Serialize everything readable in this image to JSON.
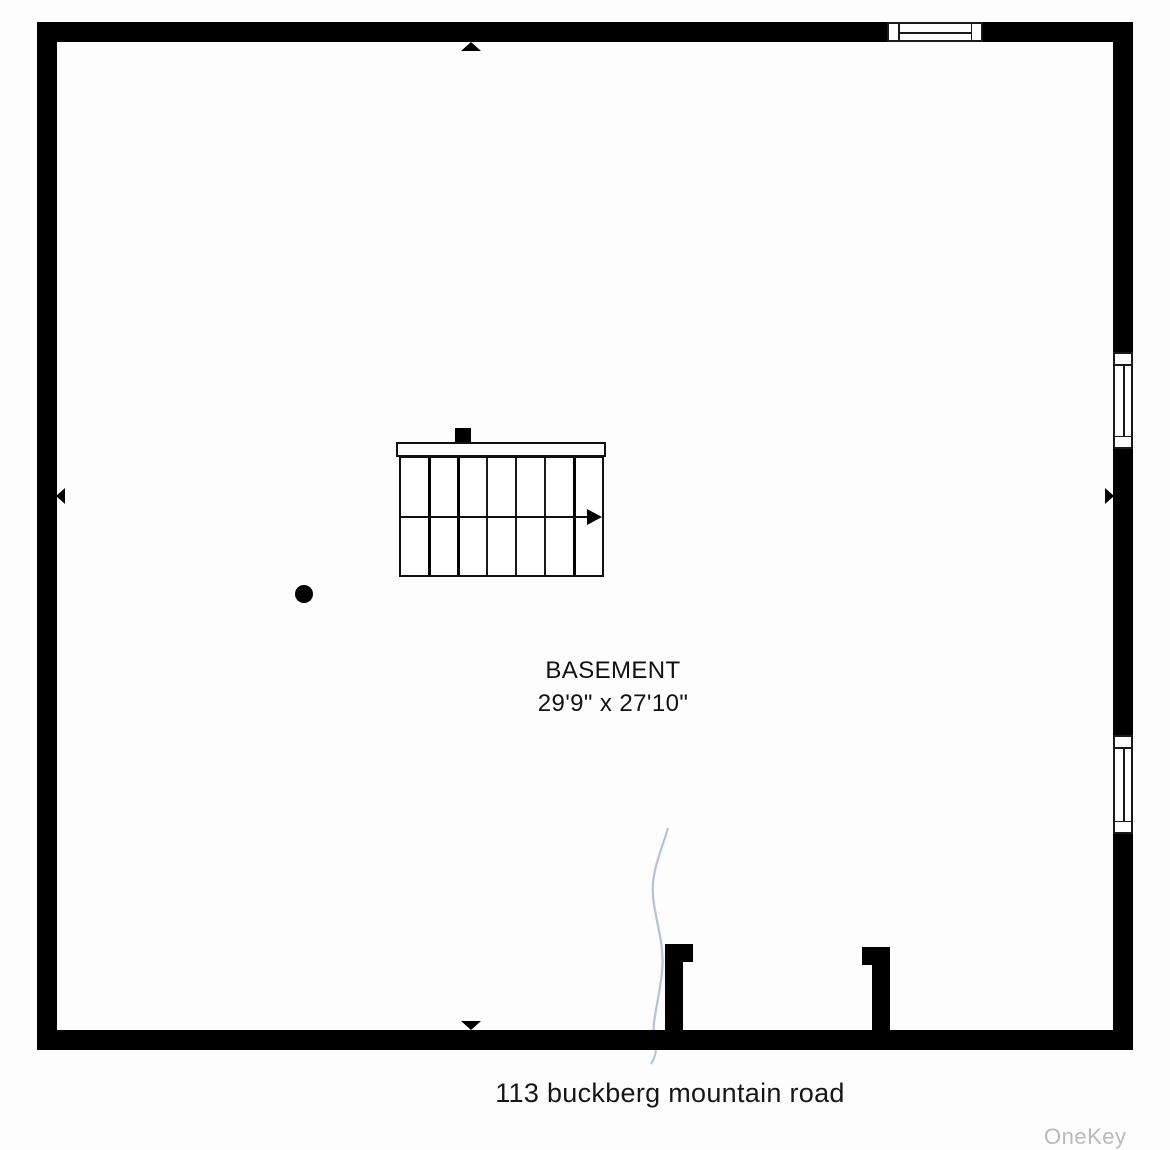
{
  "floor_plan": {
    "room_label": "BASEMENT",
    "room_dimensions": "29'9\" x 27'10\"",
    "address": "113 buckberg mountain road",
    "watermark": "OneKey MLS",
    "stair": {
      "treads": 7,
      "run_direction": "right"
    },
    "features": {
      "windows_right_wall": 2,
      "windows_top_wall": 1,
      "support_columns": 1,
      "doorway_opening_bottom": 1
    },
    "colors": {
      "wall": "#000000",
      "background": "#fdfdfe",
      "text": "#111111",
      "watermark": "#b9b9b9",
      "annotation_line": "#a8b8d0"
    }
  }
}
